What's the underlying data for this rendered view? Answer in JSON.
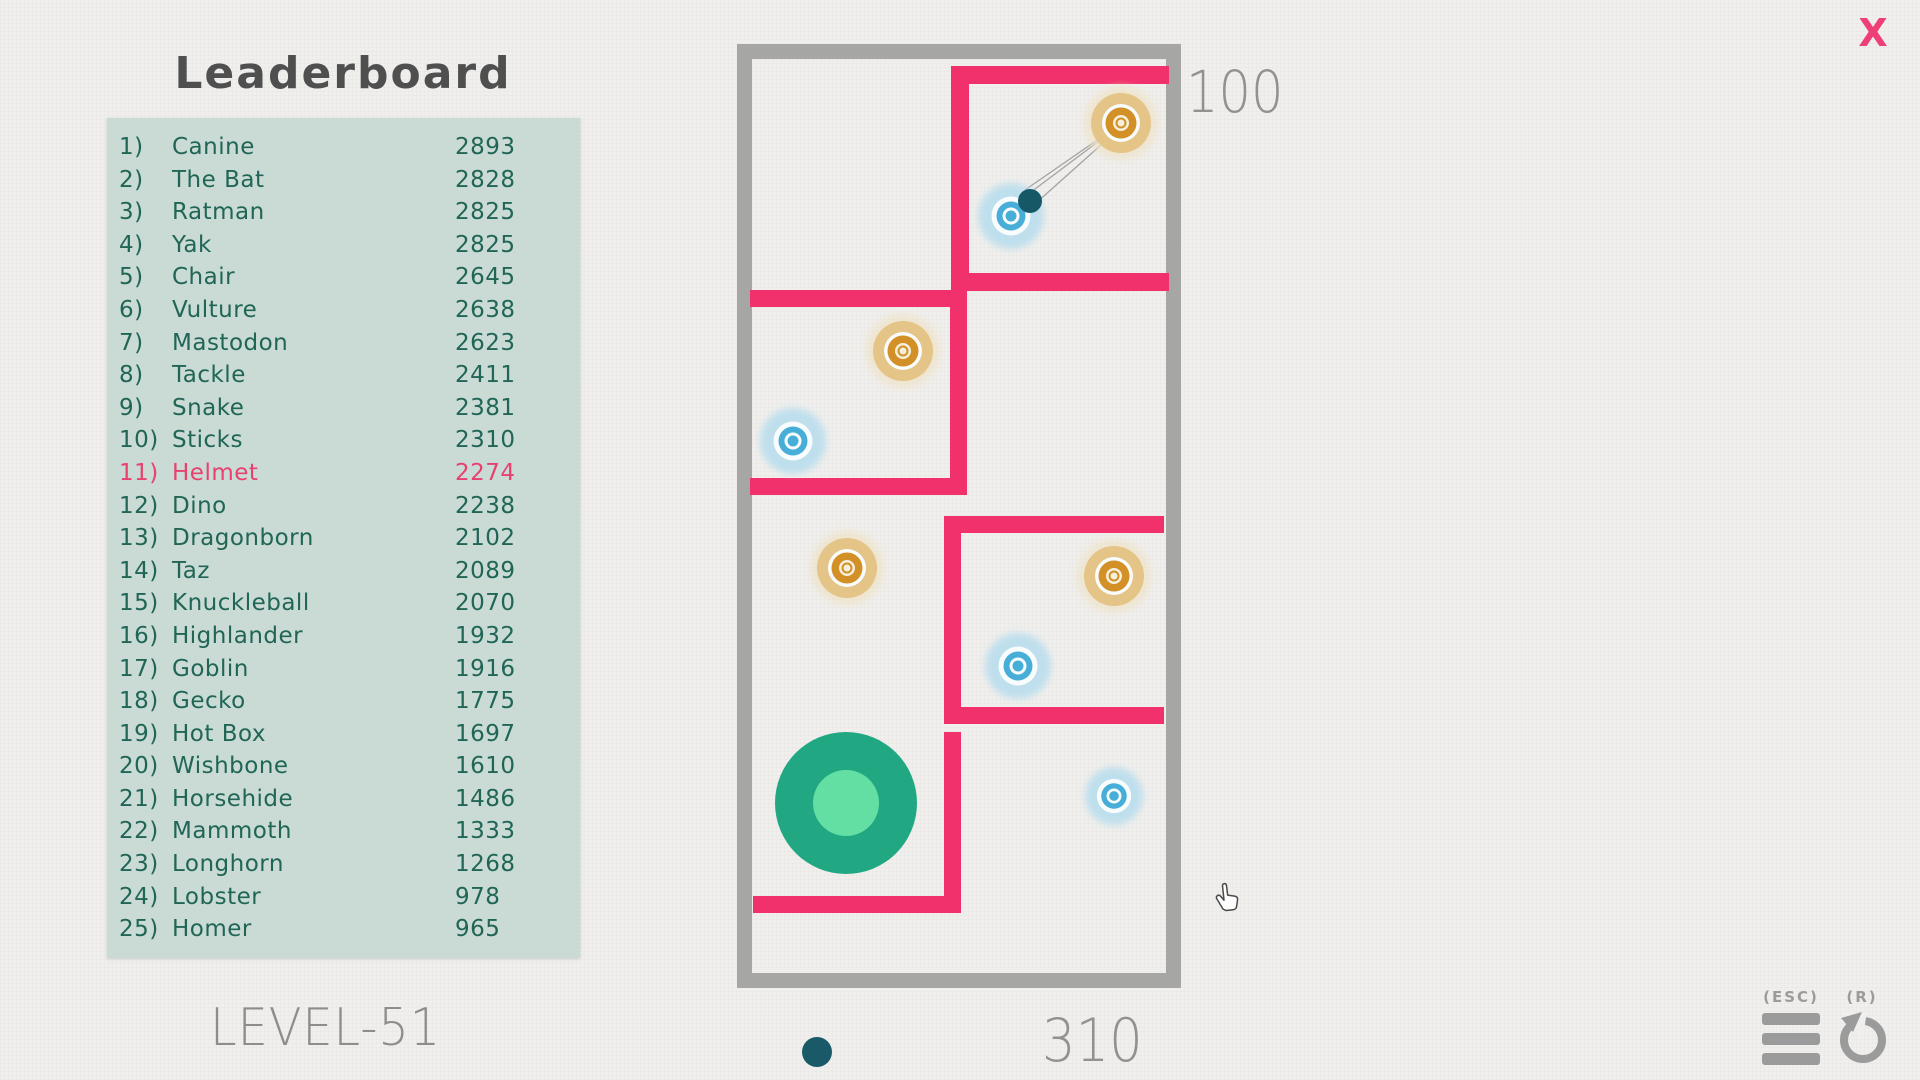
{
  "leaderboard": {
    "title": "Leaderboard",
    "entries": [
      {
        "rank": "1)",
        "name": "Canine",
        "score": "2893",
        "highlighted": false
      },
      {
        "rank": "2)",
        "name": "The Bat",
        "score": "2828",
        "highlighted": false
      },
      {
        "rank": "3)",
        "name": "Ratman",
        "score": "2825",
        "highlighted": false
      },
      {
        "rank": "4)",
        "name": "Yak",
        "score": "2825",
        "highlighted": false
      },
      {
        "rank": "5)",
        "name": "Chair",
        "score": "2645",
        "highlighted": false
      },
      {
        "rank": "6)",
        "name": "Vulture",
        "score": "2638",
        "highlighted": false
      },
      {
        "rank": "7)",
        "name": "Mastodon",
        "score": "2623",
        "highlighted": false
      },
      {
        "rank": "8)",
        "name": "Tackle",
        "score": "2411",
        "highlighted": false
      },
      {
        "rank": "9)",
        "name": "Snake",
        "score": "2381",
        "highlighted": false
      },
      {
        "rank": "10)",
        "name": "Sticks",
        "score": "2310",
        "highlighted": false
      },
      {
        "rank": "11)",
        "name": "Helmet",
        "score": "2274",
        "highlighted": true
      },
      {
        "rank": "12)",
        "name": "Dino",
        "score": "2238",
        "highlighted": false
      },
      {
        "rank": "13)",
        "name": "Dragonborn",
        "score": "2102",
        "highlighted": false
      },
      {
        "rank": "14)",
        "name": "Taz",
        "score": "2089",
        "highlighted": false
      },
      {
        "rank": "15)",
        "name": "Knuckleball",
        "score": "2070",
        "highlighted": false
      },
      {
        "rank": "16)",
        "name": "Highlander",
        "score": "1932",
        "highlighted": false
      },
      {
        "rank": "17)",
        "name": "Goblin",
        "score": "1916",
        "highlighted": false
      },
      {
        "rank": "18)",
        "name": "Gecko",
        "score": "1775",
        "highlighted": false
      },
      {
        "rank": "19)",
        "name": "Hot Box",
        "score": "1697",
        "highlighted": false
      },
      {
        "rank": "20)",
        "name": "Wishbone",
        "score": "1610",
        "highlighted": false
      },
      {
        "rank": "21)",
        "name": "Horsehide",
        "score": "1486",
        "highlighted": false
      },
      {
        "rank": "22)",
        "name": "Mammoth",
        "score": "1333",
        "highlighted": false
      },
      {
        "rank": "23)",
        "name": "Longhorn",
        "score": "1268",
        "highlighted": false
      },
      {
        "rank": "24)",
        "name": "Lobster",
        "score": "978",
        "highlighted": false
      },
      {
        "rank": "25)",
        "name": "Homer",
        "score": "965",
        "highlighted": false
      }
    ]
  },
  "level_label": "LEVEL-51",
  "hud": {
    "score_top": "100",
    "score_bottom": "310",
    "close_label": "X",
    "esc_label": "(ESC)",
    "restart_label": "(R)"
  },
  "colors": {
    "wall_pink": "#f1316b",
    "border_gray": "#a6a6a4",
    "panel_teal": "#c9dbd4",
    "list_text": "#206556",
    "highlight_pink": "#e8416f",
    "hud_gray": "#93908e",
    "icon_gray": "#9b9b9b",
    "ball_teal": "#175866",
    "green_outer": "#21a883",
    "green_inner": "#64dfa3",
    "orange_halo": "#efe3c8",
    "orange_main": "#e4c487",
    "orange_ring": "#d29027",
    "orange_cream": "#f6efdc",
    "blue_halo": "#b7ddee",
    "blue_ring": "#47aed8",
    "blue_white": "#f8fcfd",
    "aim_line": "#a3a3a3",
    "indicator_dot": "#1a5a68",
    "background": "#f0efed"
  },
  "game": {
    "border_rects": [
      {
        "x": 737,
        "y": 44,
        "w": 444,
        "h": 15
      },
      {
        "x": 737,
        "y": 973,
        "w": 444,
        "h": 15
      },
      {
        "x": 737,
        "y": 44,
        "w": 15,
        "h": 944
      },
      {
        "x": 1166,
        "y": 44,
        "w": 15,
        "h": 944
      }
    ],
    "walls": [
      {
        "x": 951,
        "y": 66,
        "w": 218,
        "h": 18,
        "name": "room1-top-wall"
      },
      {
        "x": 951,
        "y": 66,
        "w": 18,
        "h": 225,
        "name": "room1-left-wall"
      },
      {
        "x": 951,
        "y": 273,
        "w": 218,
        "h": 18,
        "name": "room1-bottom-wall"
      },
      {
        "x": 750,
        "y": 290,
        "w": 217,
        "h": 17,
        "name": "room2-top-wall"
      },
      {
        "x": 950,
        "y": 290,
        "w": 17,
        "h": 205,
        "name": "room2-right-wall"
      },
      {
        "x": 750,
        "y": 478,
        "w": 217,
        "h": 17,
        "name": "room2-bottom-wall"
      },
      {
        "x": 944,
        "y": 516,
        "w": 220,
        "h": 17,
        "name": "room3-top-wall"
      },
      {
        "x": 944,
        "y": 516,
        "w": 17,
        "h": 208,
        "name": "room3-left-wall"
      },
      {
        "x": 944,
        "y": 707,
        "w": 220,
        "h": 17,
        "name": "room3-bottom-wall"
      },
      {
        "x": 944,
        "y": 732,
        "w": 17,
        "h": 181,
        "name": "lower-vertical-wall"
      },
      {
        "x": 753,
        "y": 896,
        "w": 208,
        "h": 17,
        "name": "lower-horizontal-wall"
      }
    ],
    "targets": [
      {
        "type": "orange",
        "x": 1121,
        "y": 123,
        "s": 1
      },
      {
        "type": "blue",
        "x": 1011,
        "y": 216,
        "s": 1
      },
      {
        "type": "orange",
        "x": 903,
        "y": 351,
        "s": 1
      },
      {
        "type": "blue",
        "x": 793,
        "y": 441,
        "s": 1
      },
      {
        "type": "orange",
        "x": 847,
        "y": 568,
        "s": 1
      },
      {
        "type": "orange",
        "x": 1114,
        "y": 576,
        "s": 1
      },
      {
        "type": "blue",
        "x": 1018,
        "y": 666,
        "s": 1
      },
      {
        "type": "blue",
        "x": 1114,
        "y": 796,
        "s": 0.88
      }
    ],
    "aim_lines": [
      {
        "x1": 1119,
        "y1": 125,
        "x2": 1025,
        "y2": 190
      },
      {
        "x1": 1119,
        "y1": 126,
        "x2": 1019,
        "y2": 201
      },
      {
        "x1": 1120,
        "y1": 128,
        "x2": 1026,
        "y2": 212
      }
    ],
    "ball": {
      "x": 1030,
      "y": 201,
      "r": 12
    },
    "launcher": {
      "x": 846,
      "y": 803,
      "r_outer": 71,
      "r_inner": 33
    },
    "indicator_dot": {
      "x": 817,
      "y": 1052,
      "r": 15
    },
    "cursor": {
      "x": 1211,
      "y": 884
    }
  }
}
